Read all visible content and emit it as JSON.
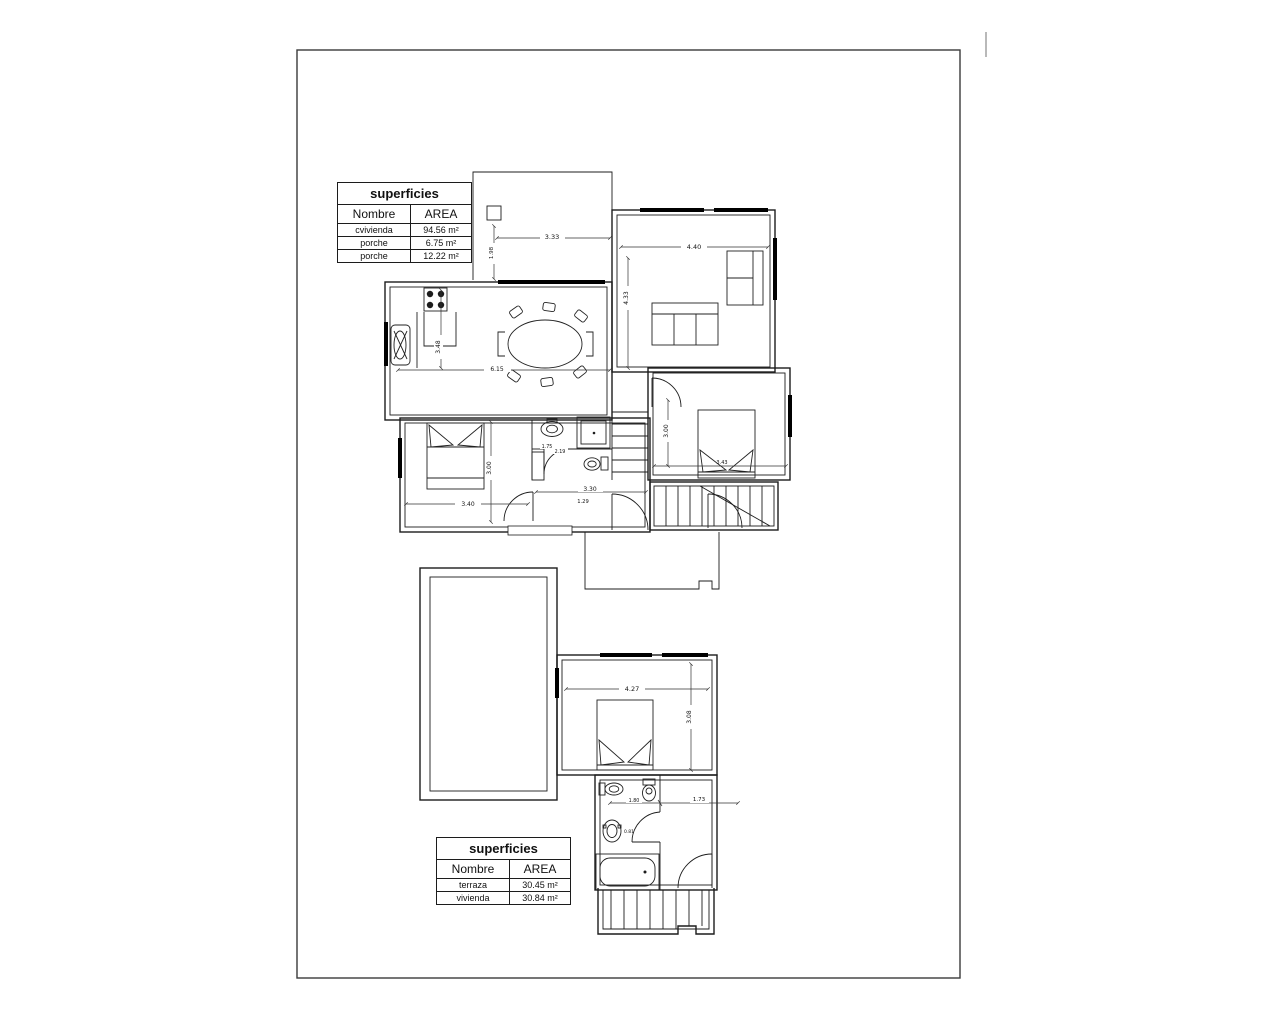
{
  "page": {
    "background": "#ffffff",
    "line_color": "#1c1c1c"
  },
  "tables": {
    "upper": {
      "title": "superficies",
      "col_nombre": "Nombre",
      "col_area": "AREA",
      "rows": [
        {
          "nombre": "cvivienda",
          "area": "94.56 m²"
        },
        {
          "nombre": "porche",
          "area": "6.75 m²"
        },
        {
          "nombre": "porche",
          "area": "12.22 m²"
        }
      ]
    },
    "lower": {
      "title": "superficies",
      "col_nombre": "Nombre",
      "col_area": "AREA",
      "rows": [
        {
          "nombre": "terraza",
          "area": "30.45 m²"
        },
        {
          "nombre": "vivienda",
          "area": "30.84 m²"
        }
      ]
    }
  },
  "plans": {
    "upper": {
      "dims": {
        "porch_depth": "1.98",
        "porch_width": "3.33",
        "living_width": "4.40",
        "living_height": "4.33",
        "kitchen_height": "3.48",
        "kitchen_width": "6.15",
        "bedroom_left_height": "3.00",
        "bedroom_left_width": "3.40",
        "bath_a": "1.75",
        "bath_b": "2.19",
        "hall_width": "3.30",
        "hall_depth": "1.29",
        "bedroom_right_height": "3.00",
        "bedroom_right_width": "3.43"
      }
    },
    "lower": {
      "dims": {
        "bedroom_width": "4.27",
        "bedroom_height": "3.08",
        "bath_width": "1.80",
        "sink": "0.81",
        "hall_width": "1.73"
      }
    }
  }
}
